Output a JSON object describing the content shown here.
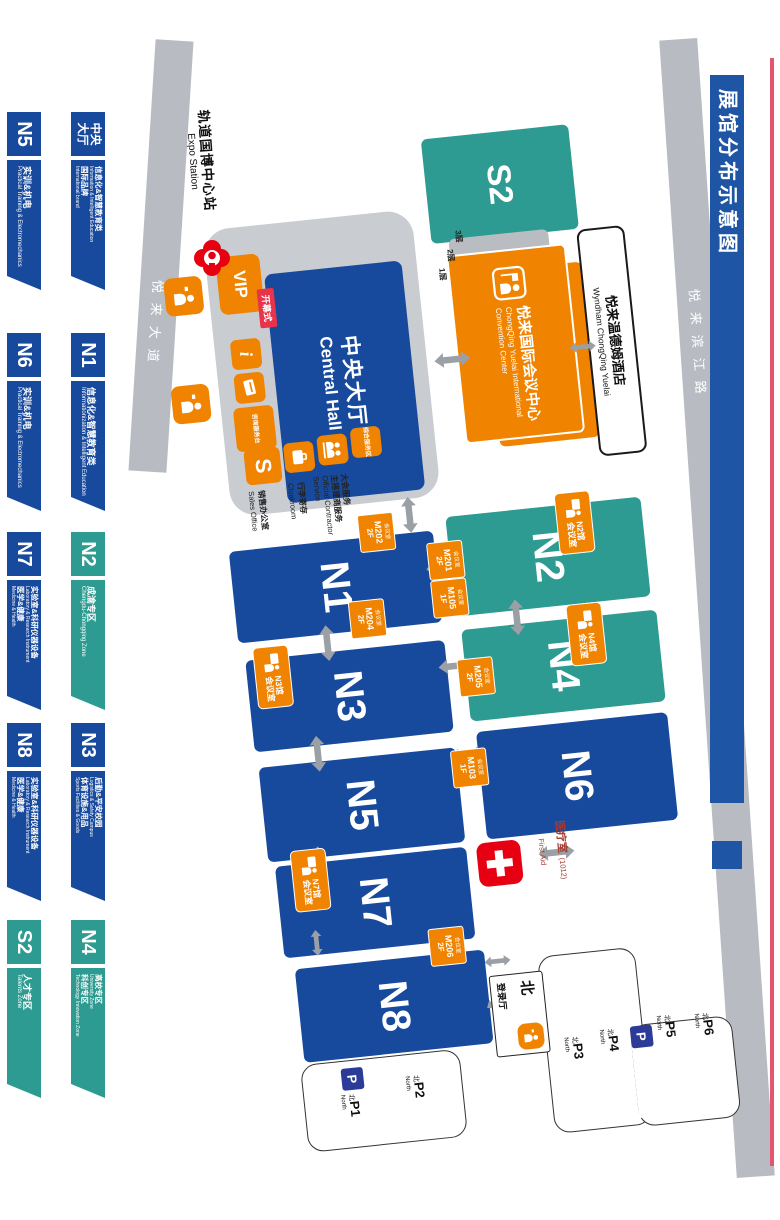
{
  "title": "展馆分布示意图",
  "station": {
    "zh": "轨道国博中心站",
    "en": "Expo Station"
  },
  "roads": {
    "avenue": "悦来大道",
    "binjiang": "悦来滨江路"
  },
  "halls": {
    "s2": "S2",
    "n1": "N1",
    "n2": "N2",
    "n3": "N3",
    "n4": "N4",
    "n5": "N5",
    "n6": "N6",
    "n7": "N7",
    "n8": "N8",
    "central": {
      "zh": "中央大厅",
      "en": "Central Hall"
    }
  },
  "central_services": {
    "vip": "VIP",
    "opening_ceremony": "开幕式",
    "info_i": "i",
    "sales_initial": "S",
    "sales_office": {
      "zh": "销售办公室",
      "en": "Sales Office"
    },
    "cloakroom": {
      "zh": "行李寄存",
      "en": "Cloakroom"
    },
    "contractor": {
      "zh1": "大会服务",
      "zh2": "主搭建商服务",
      "en": "Official Contractor Service"
    },
    "service_desk": "咨询服务台",
    "service_area": "综合服务区"
  },
  "convention_center": {
    "zh": "悦来国际会议中心",
    "en1": "ChongQing Yuelai International",
    "en2": "Convention Center",
    "floors": [
      "3层",
      "2层",
      "1层"
    ]
  },
  "hotel": {
    "zh": "悦来温德姆酒店",
    "en": "Wyndham ChongQing Yuelai"
  },
  "first_aid": {
    "zh": "医疗室",
    "code": "(1012)",
    "en": "First Aid"
  },
  "north_hall": {
    "big": "北",
    "rest": "登录厅"
  },
  "meeting_rooms": [
    {
      "id": "m202",
      "zh": "会议室",
      "room": "M202",
      "floor": "2F"
    },
    {
      "id": "m204",
      "zh": "会议室",
      "room": "M204",
      "floor": "2F"
    },
    {
      "id": "m201",
      "zh": "会议室",
      "room": "M201",
      "floor": "2F"
    },
    {
      "id": "m105",
      "zh": "会议室",
      "room": "M105",
      "floor": "1F"
    },
    {
      "id": "m205",
      "zh": "会议室",
      "room": "M205",
      "floor": "2F"
    },
    {
      "id": "m103",
      "zh": "会议室",
      "room": "M103",
      "floor": "1F"
    },
    {
      "id": "m206",
      "zh": "会议室",
      "room": "M206",
      "floor": "2F"
    }
  ],
  "hall_meeting_rooms": [
    {
      "id": "n2",
      "line1": "N2馆",
      "line2": "会议室"
    },
    {
      "id": "n4",
      "line1": "N4馆",
      "line2": "会议室"
    },
    {
      "id": "n3",
      "line1": "N3馆",
      "line2": "会议室"
    },
    {
      "id": "n7",
      "line1": "N7馆",
      "line2": "会议室"
    }
  ],
  "parking": {
    "north_zh": "北",
    "north_en": "North",
    "p_letter": "P",
    "lots": [
      "P1",
      "P2",
      "P3",
      "P4",
      "P5",
      "P6"
    ]
  },
  "legend": {
    "row1": [
      {
        "code": "中央大厅",
        "color": "blue",
        "lines": [
          {
            "zh": "信息化&智慧教育类",
            "en": "Information & Intelligent Education"
          },
          {
            "zh": "国际品牌",
            "en": "International brand"
          }
        ]
      },
      {
        "code": "N1",
        "color": "blue",
        "lines": [
          {
            "zh": "信息化&智慧教育类",
            "en": "Informationization & Intelligent Education"
          }
        ]
      },
      {
        "code": "N2",
        "color": "teal",
        "lines": [
          {
            "zh": "成渝专区",
            "en": "Chengdu-Chongqing Zone"
          }
        ]
      },
      {
        "code": "N3",
        "color": "blue",
        "lines": [
          {
            "zh": "后勤&平安校园",
            "en": "Logistics & Safety Campus"
          },
          {
            "zh": "体育设施&用品",
            "en": "Sports Facilities & Goods"
          }
        ]
      },
      {
        "code": "N4",
        "color": "teal",
        "lines": [
          {
            "zh": "高校专区",
            "en": "University Zone"
          },
          {
            "zh": "科创专区",
            "en": "Technology Innovation Zone"
          }
        ]
      }
    ],
    "row2": [
      {
        "code": "N5",
        "color": "blue",
        "lines": [
          {
            "zh": "实训&机电",
            "en": "Practical Training & Electromechanics"
          }
        ]
      },
      {
        "code": "N6",
        "color": "blue",
        "lines": [
          {
            "zh": "实训&机电",
            "en": "Practical Training & Electromechanics"
          }
        ]
      },
      {
        "code": "N7",
        "color": "blue",
        "lines": [
          {
            "zh": "实验室&科研仪器设备",
            "en": "Laboratory & Research Instrument"
          },
          {
            "zh": "医学&健康",
            "en": "Medicine & Health"
          }
        ]
      },
      {
        "code": "N8",
        "color": "blue",
        "lines": [
          {
            "zh": "实验室&科研仪器设备",
            "en": "Laboratory & Research Instrument"
          },
          {
            "zh": "医学&健康",
            "en": "Medicine & Health"
          }
        ]
      },
      {
        "code": "S2",
        "color": "teal",
        "lines": [
          {
            "zh": "人才专区",
            "en": "Talents Zone"
          }
        ]
      }
    ]
  },
  "colors": {
    "hall_blue": "#17499d",
    "hall_teal": "#2d9b91",
    "orange": "#f08300",
    "red": "#e60012",
    "road_gray": "#b8bcc2",
    "central_gray": "#c9ccd1",
    "arrow_gray": "#9aa0a6",
    "p_blue": "#2b3b97",
    "accent_line": "#e4556f",
    "title_blue": "#1f55a5"
  }
}
